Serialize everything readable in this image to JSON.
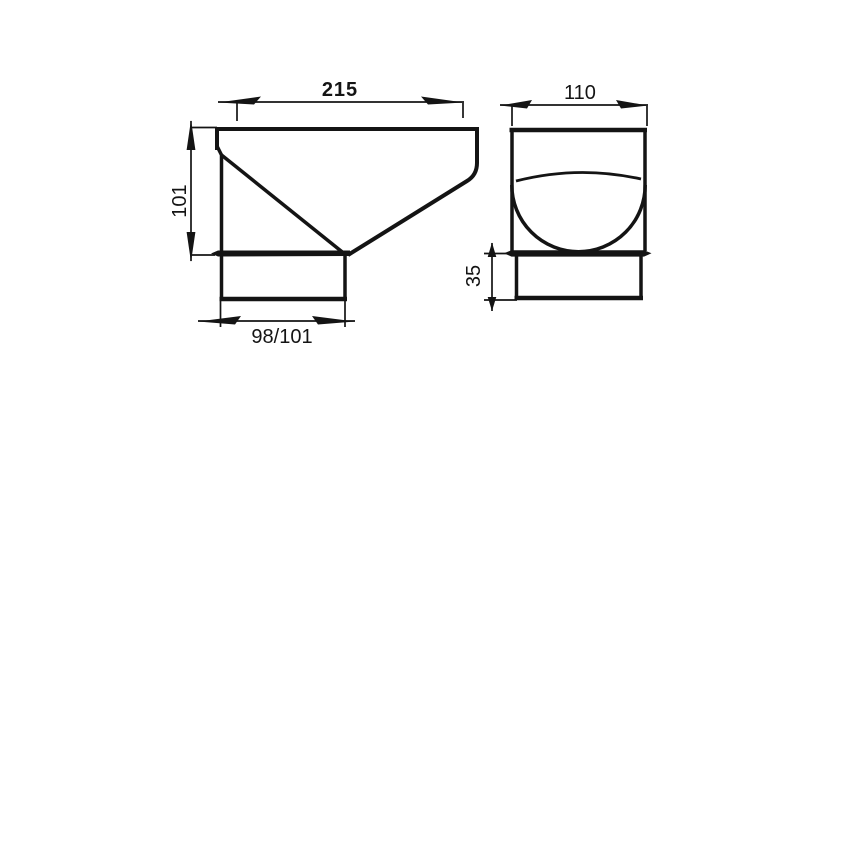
{
  "colors": {
    "background": "#ffffff",
    "line": "#141414"
  },
  "drawing": {
    "views": {
      "side_view": {
        "dimensions": {
          "top_width": "215",
          "height": "101",
          "bottom_width": "98/101"
        }
      },
      "front_view": {
        "dimensions": {
          "width": "110",
          "collar_height": "35"
        }
      }
    }
  }
}
